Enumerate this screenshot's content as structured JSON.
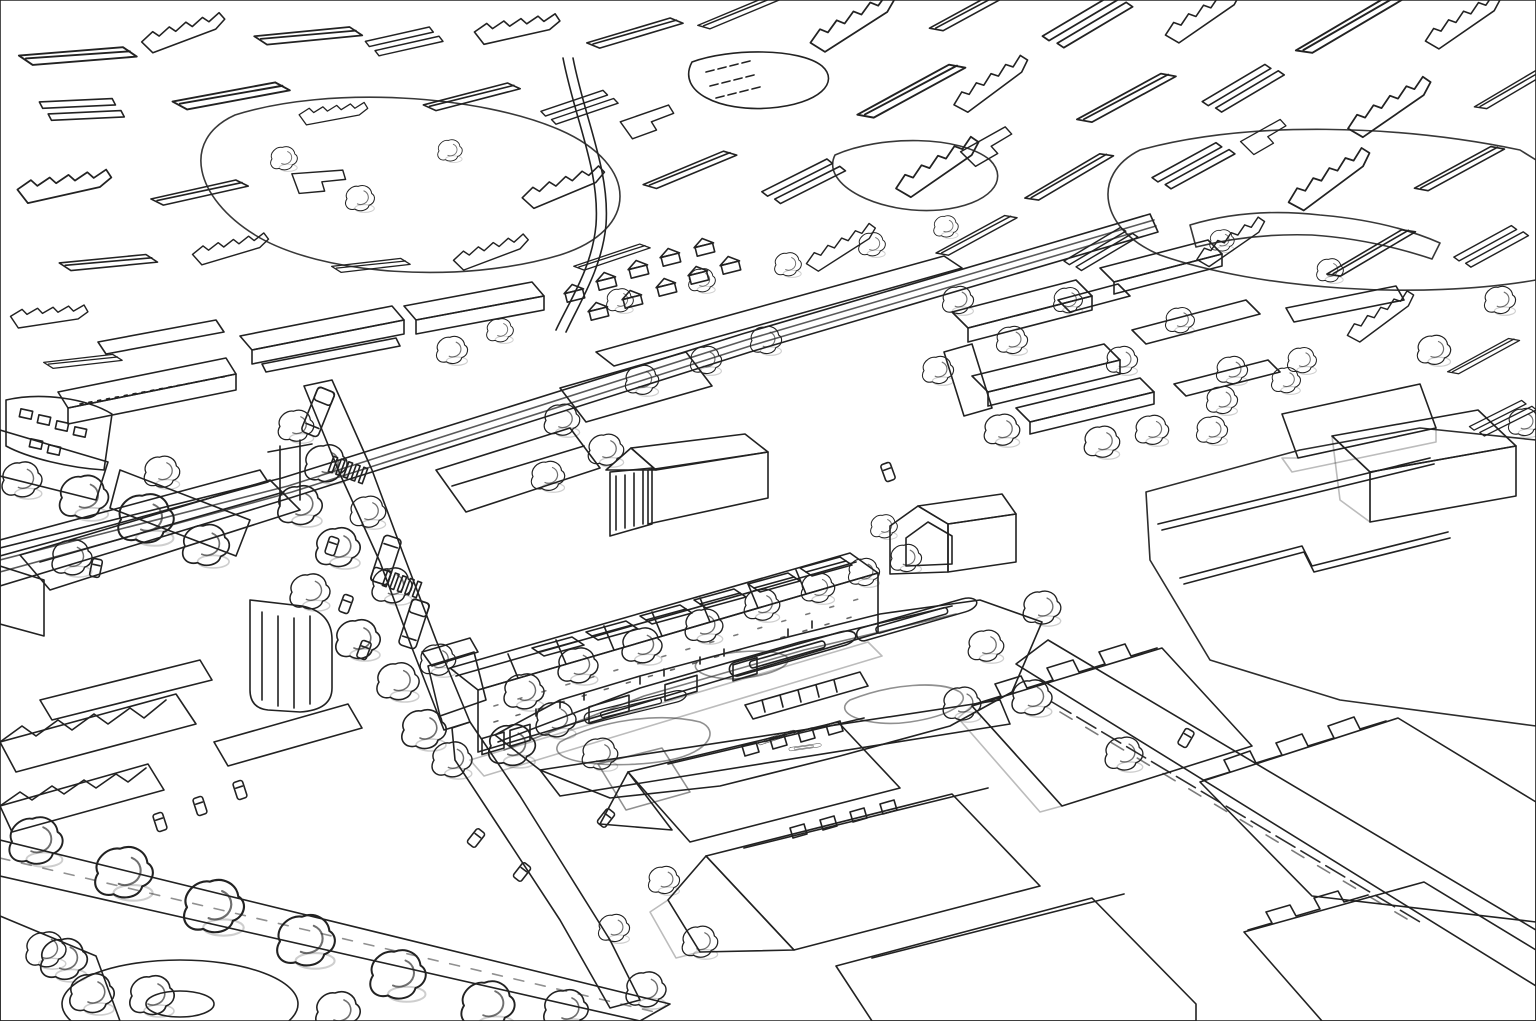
{
  "scene": {
    "title": "Aerial sketch masterplan of a town centre",
    "description": "Hand-drawn watercolour-style aerial perspective: line-sketched existing town at the top, railway line and station, tree-lined high street with buses, canal basin with narrowboats, jetty and wharf shopfronts, new housing courts with pink roofs, playing fields, large warehouses and industrial sheds.",
    "trees": [
      [
        296,
        428,
        0.8
      ],
      [
        326,
        466,
        0.95
      ],
      [
        300,
        508,
        1
      ],
      [
        338,
        550,
        1
      ],
      [
        310,
        594,
        0.9
      ],
      [
        368,
        514,
        0.8
      ],
      [
        392,
        588,
        0.9
      ],
      [
        358,
        642,
        1
      ],
      [
        398,
        684,
        0.95
      ],
      [
        438,
        662,
        0.8
      ],
      [
        424,
        732,
        1
      ],
      [
        452,
        762,
        0.9
      ],
      [
        84,
        500,
        1.1
      ],
      [
        146,
        522,
        1.25
      ],
      [
        206,
        548,
        1.05
      ],
      [
        72,
        560,
        0.9
      ],
      [
        162,
        474,
        0.8
      ],
      [
        22,
        482,
        0.9
      ],
      [
        524,
        694,
        0.9
      ],
      [
        578,
        668,
        0.9
      ],
      [
        642,
        648,
        0.9
      ],
      [
        704,
        628,
        0.85
      ],
      [
        762,
        607,
        0.8
      ],
      [
        818,
        590,
        0.75
      ],
      [
        864,
        574,
        0.7
      ],
      [
        512,
        748,
        1.05
      ],
      [
        556,
        722,
        0.9
      ],
      [
        600,
        756,
        0.8
      ],
      [
        36,
        844,
        1.2
      ],
      [
        124,
        876,
        1.3
      ],
      [
        214,
        910,
        1.35
      ],
      [
        306,
        944,
        1.3
      ],
      [
        398,
        978,
        1.25
      ],
      [
        488,
        1008,
        1.2
      ],
      [
        64,
        962,
        1.05
      ],
      [
        152,
        998,
        1
      ],
      [
        338,
        1014,
        1
      ],
      [
        566,
        1012,
        1
      ],
      [
        46,
        952,
        0.9
      ],
      [
        92,
        996,
        1
      ],
      [
        958,
        302,
        0.7
      ],
      [
        1012,
        342,
        0.7
      ],
      [
        1068,
        302,
        0.65
      ],
      [
        1122,
        362,
        0.7
      ],
      [
        1180,
        322,
        0.65
      ],
      [
        1232,
        372,
        0.7
      ],
      [
        1002,
        432,
        0.8
      ],
      [
        1102,
        444,
        0.8
      ],
      [
        1212,
        432,
        0.7
      ],
      [
        1286,
        382,
        0.65
      ],
      [
        938,
        372,
        0.7
      ],
      [
        452,
        352,
        0.7
      ],
      [
        500,
        332,
        0.6
      ],
      [
        620,
        302,
        0.6
      ],
      [
        702,
        282,
        0.6
      ],
      [
        788,
        266,
        0.6
      ],
      [
        872,
        246,
        0.6
      ],
      [
        946,
        228,
        0.55
      ],
      [
        642,
        382,
        0.75
      ],
      [
        706,
        362,
        0.7
      ],
      [
        766,
        342,
        0.7
      ],
      [
        562,
        422,
        0.8
      ],
      [
        606,
        452,
        0.8
      ],
      [
        548,
        478,
        0.75
      ],
      [
        1042,
        610,
        0.85
      ],
      [
        986,
        648,
        0.8
      ],
      [
        1032,
        700,
        0.9
      ],
      [
        1124,
        756,
        0.85
      ],
      [
        962,
        706,
        0.85
      ],
      [
        1152,
        432,
        0.75
      ],
      [
        1222,
        402,
        0.7
      ],
      [
        1302,
        362,
        0.65
      ],
      [
        1434,
        352,
        0.75
      ],
      [
        1500,
        302,
        0.7
      ],
      [
        1524,
        424,
        0.7
      ],
      [
        664,
        882,
        0.7
      ],
      [
        700,
        944,
        0.8
      ],
      [
        646,
        992,
        0.9
      ],
      [
        614,
        930,
        0.7
      ],
      [
        284,
        160,
        0.6
      ],
      [
        360,
        200,
        0.65
      ],
      [
        450,
        152,
        0.55
      ],
      [
        1222,
        242,
        0.55
      ],
      [
        1330,
        272,
        0.6
      ],
      [
        906,
        560,
        0.7
      ],
      [
        884,
        528,
        0.6
      ]
    ],
    "buses": [
      [
        318,
        412,
        202
      ],
      [
        386,
        560,
        18
      ],
      [
        414,
        624,
        198
      ]
    ],
    "cars": [
      [
        346,
        604,
        20
      ],
      [
        364,
        650,
        20
      ],
      [
        332,
        546,
        18
      ],
      [
        476,
        838,
        38
      ],
      [
        522,
        872,
        38
      ],
      [
        1186,
        738,
        30
      ],
      [
        240,
        790,
        -18
      ],
      [
        200,
        806,
        -18
      ],
      [
        160,
        822,
        -18
      ],
      [
        96,
        568,
        12
      ],
      [
        888,
        472,
        -20
      ],
      [
        606,
        818,
        38
      ]
    ],
    "boats": [
      [
        796,
        652,
        -16,
        1
      ],
      [
        920,
        618,
        -16,
        0.95
      ],
      [
        638,
        706,
        -14,
        0.8
      ],
      [
        778,
        737,
        -18,
        0.3
      ],
      [
        806,
        747,
        -8,
        0.25
      ]
    ]
  },
  "features": [
    "existing-town-line-sketch",
    "railway-line",
    "railway-station",
    "station-footbridge",
    "high-street",
    "zebra-crossings",
    "canal-basin",
    "narrowboats",
    "timber-jetty",
    "wharf-terrace-shopfronts",
    "classical-maltings-building",
    "new-housing-courts",
    "playing-field",
    "sports-building",
    "industrial-sheds",
    "warehouses",
    "tree-lined-avenue",
    "roundabout",
    "car-park"
  ],
  "palette": {
    "ink": "#222222",
    "paper": "#ffffff",
    "wash_green": "#e3f2c5",
    "grass": "#cdeb9d",
    "field": "#cfec9f",
    "tree": "#b5e37d",
    "tree_dark": "#8cc45d",
    "boat": "#7abf62",
    "roof_gray": "#d8dde4",
    "roof_pink": "#c7a3a9",
    "roof_peach": "#e6c5a0",
    "wall_cream": "#f3ead6",
    "wall_yellow": "#ede3bd",
    "wall_white": "#fbfaf6",
    "wall_pink": "#f2e6e2",
    "maroon": "#b4606a",
    "road": "#f1eae6",
    "pave": "#ebe4da",
    "water": "#f7f8fa",
    "water_shade": "#c5cfd8",
    "shadow": "#aeb6bf",
    "bus_red": "#d9505e",
    "sf_magenta": "#c050ae",
    "sf_yellow": "#e2d052",
    "sf_orange": "#e49140"
  }
}
